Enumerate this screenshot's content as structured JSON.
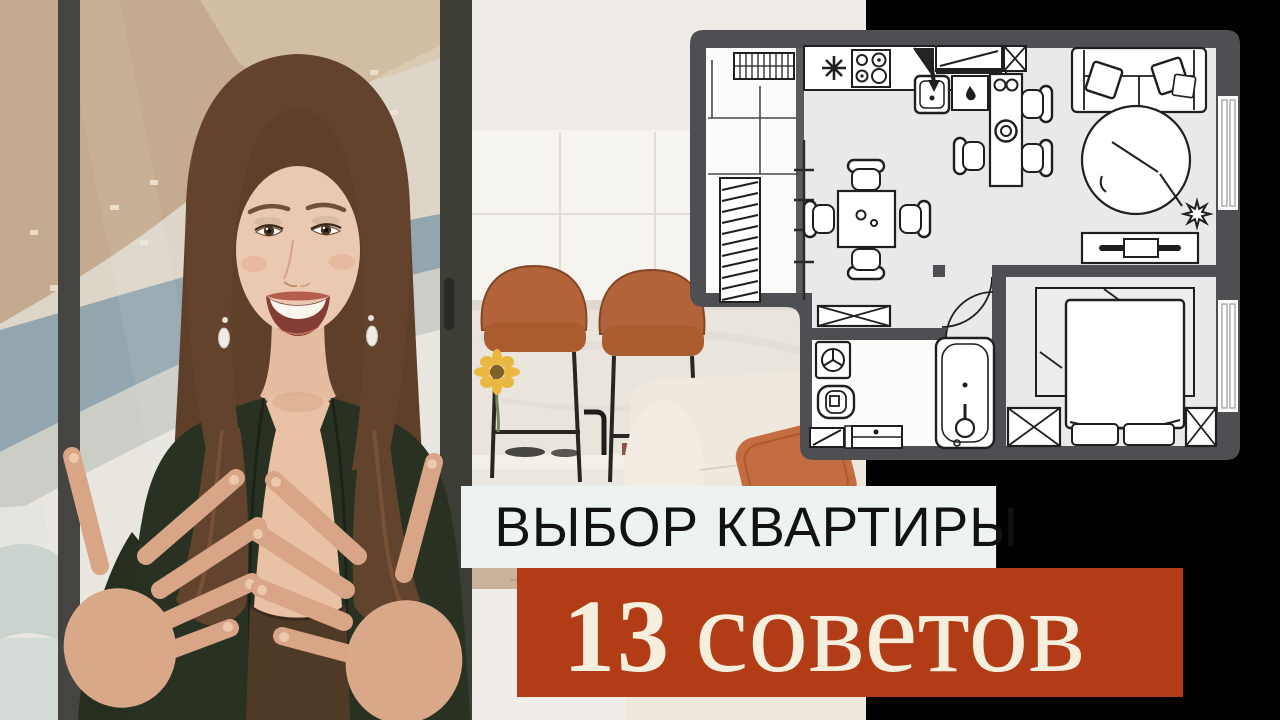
{
  "banners": {
    "primary": {
      "text": "ВЫБОР КВАРТИРЫ",
      "bg_color": "#edf3f1",
      "text_color": "#121212"
    },
    "secondary": {
      "number": "13",
      "word": "советов",
      "bg_color": "#b23c15",
      "text_color": "#f7efdd"
    }
  },
  "floor_plan": {
    "wall_color": "#4e4f52",
    "floor_color": "#e9e9ea",
    "rooms": [
      "balcony",
      "kitchen",
      "living-dining-room",
      "hallway",
      "bathroom",
      "bedroom"
    ],
    "furniture": [
      "drying-rack",
      "radiator",
      "kitchen-counter",
      "stove",
      "kitchen-sink",
      "fridge",
      "bar-counter",
      "bar-stools",
      "dining-table",
      "dining-chairs",
      "sofa",
      "cushions",
      "round-rug",
      "plant",
      "tv-console",
      "hall-wardrobe",
      "washing-machine",
      "toilet",
      "bathtub",
      "vanity",
      "double-bed",
      "pillows",
      "bedside-wardrobes"
    ],
    "window_count": 2
  },
  "photo": {
    "scene": "presenter speaking in bright apartment",
    "elements": [
      "hillside-city-and-sea-view",
      "window-frame",
      "white-kitchen-cabinets",
      "marble-backsplash",
      "black-faucet",
      "two-leather-bar-stools",
      "sunflower",
      "white-sofa",
      "orange-cushion",
      "woman-in-dark-green-blazer-gesturing"
    ]
  }
}
